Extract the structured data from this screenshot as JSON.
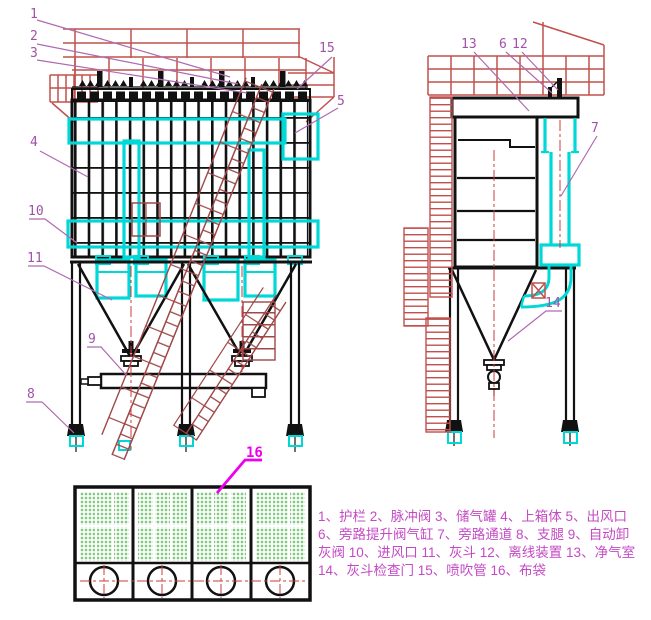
{
  "drawing": {
    "type": "pulse-jet bag filter dust collector general arrangement",
    "views": [
      "front-view",
      "side-view",
      "bottom-detail-view"
    ]
  },
  "colors": {
    "line_black": "#111111",
    "rail_red": "#c0504d",
    "stair_red": "#9e4848",
    "centerline_red": "#cc3b3b",
    "highlight_cyan": "#00d8d8",
    "callout_magenta": "#a052a8",
    "bright_magenta": "#ee00ee",
    "legend_magenta": "#c44ac4",
    "bag_green": "#82cc82"
  },
  "callouts": {
    "c1": "1",
    "c2": "2",
    "c3": "3",
    "c4": "4",
    "c5": "5",
    "c6": "6",
    "c7": "7",
    "c8": "8",
    "c9": "9",
    "c10": "10",
    "c11": "11",
    "c12": "12",
    "c13": "13",
    "c14": "14",
    "c15": "15",
    "c16": "16"
  },
  "legend": {
    "line1": "1、护栏 2、脉冲阀 3、储气罐 4、上箱体 5、出风口",
    "line2": "6、旁路提升阀气缸 7、旁路通道 8、支腿 9、自动卸",
    "line3": "灰阀 10、进风口 11、灰斗 12、离线装置 13、净气室",
    "line4": "14、灰斗检查门 15、喷吹管 16、布袋"
  }
}
